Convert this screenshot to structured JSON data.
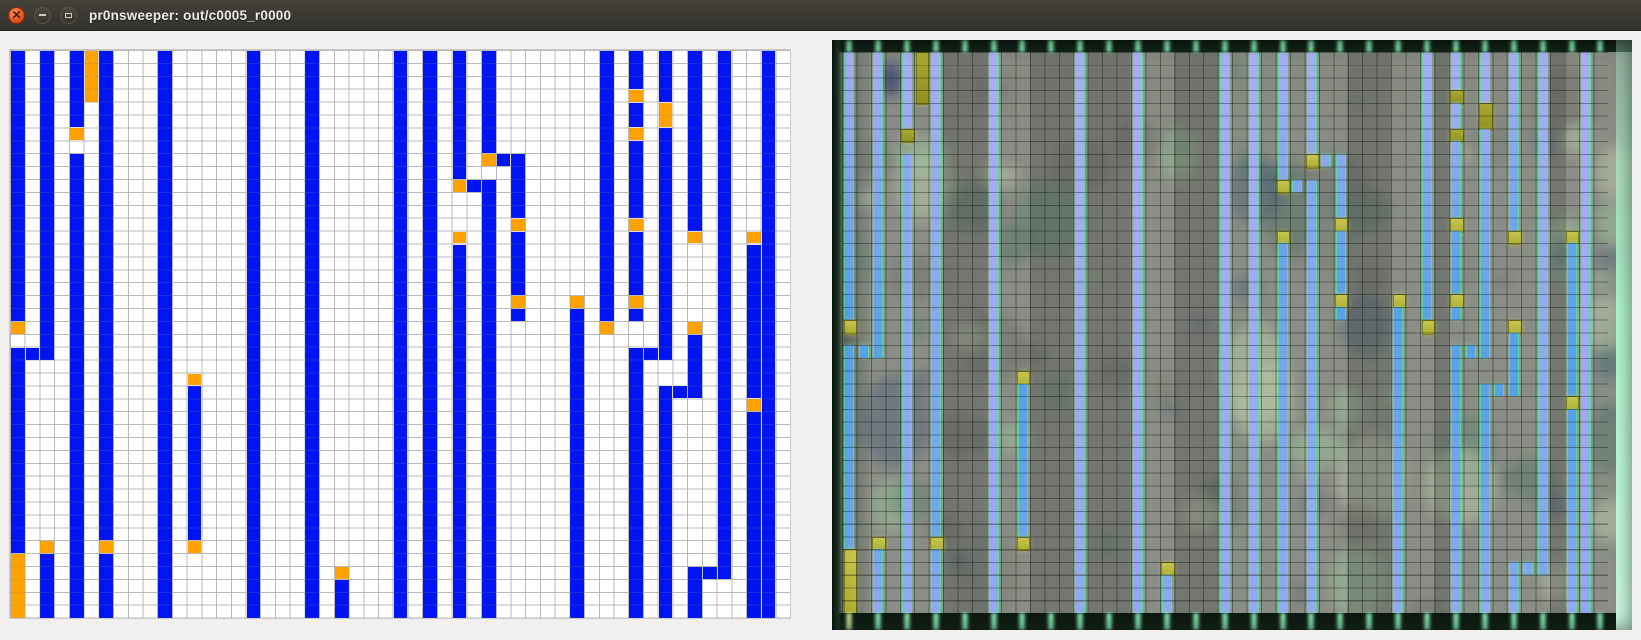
{
  "window": {
    "title": "pr0nsweeper: out/c0005_r0000",
    "controls": {
      "close": "close-icon",
      "minimize": "minimize-icon",
      "maximize": "maximize-icon"
    }
  },
  "colors": {
    "titlebar_bg": "#3a3833",
    "close_button": "#e2582a",
    "mark_blue": "#0014f2",
    "flag_orange": "#ffa200",
    "grid_line": "#c9c9c9",
    "photo_bg": "#8b8e86",
    "trace_top_lavender": "#a9aef2",
    "trace_mid_blue": "#58a2e6",
    "flag_yellow": "#b9ba3c",
    "flag_olive_dark": "#9b9b26",
    "band_dark_green": "#0c1710",
    "band_streak_mint": "#8af2bc",
    "photo_edge_mint": "#aef3cd"
  },
  "bit_grid": {
    "cols": 53,
    "rows": 44,
    "legend": {
      "B": "blue-trace-mark",
      "O": "orange-flag-mark"
    },
    "columns": [
      {
        "col": 0,
        "runs": [
          [
            0,
            20,
            "B"
          ],
          [
            21,
            21,
            "O"
          ],
          [
            23,
            38,
            "B"
          ],
          [
            39,
            43,
            "O"
          ]
        ]
      },
      {
        "col": 1,
        "runs": [
          [
            23,
            23,
            "B"
          ]
        ]
      },
      {
        "col": 2,
        "runs": [
          [
            0,
            23,
            "B"
          ],
          [
            38,
            38,
            "O"
          ],
          [
            39,
            43,
            "B"
          ]
        ]
      },
      {
        "col": 4,
        "runs": [
          [
            0,
            5,
            "B"
          ],
          [
            6,
            6,
            "O"
          ],
          [
            8,
            43,
            "B"
          ]
        ]
      },
      {
        "col": 5,
        "runs": [
          [
            0,
            3,
            "O"
          ]
        ]
      },
      {
        "col": 6,
        "runs": [
          [
            0,
            37,
            "B"
          ],
          [
            38,
            38,
            "O"
          ],
          [
            39,
            43,
            "B"
          ]
        ]
      },
      {
        "col": 10,
        "runs": [
          [
            0,
            43,
            "B"
          ]
        ]
      },
      {
        "col": 12,
        "runs": [
          [
            25,
            25,
            "O"
          ],
          [
            26,
            37,
            "B"
          ],
          [
            38,
            38,
            "O"
          ]
        ]
      },
      {
        "col": 16,
        "runs": [
          [
            0,
            43,
            "B"
          ]
        ]
      },
      {
        "col": 20,
        "runs": [
          [
            0,
            43,
            "B"
          ]
        ]
      },
      {
        "col": 22,
        "runs": [
          [
            40,
            40,
            "O"
          ],
          [
            41,
            43,
            "B"
          ]
        ]
      },
      {
        "col": 26,
        "runs": [
          [
            0,
            43,
            "B"
          ]
        ]
      },
      {
        "col": 28,
        "runs": [
          [
            0,
            43,
            "B"
          ]
        ]
      },
      {
        "col": 30,
        "runs": [
          [
            0,
            9,
            "B"
          ],
          [
            10,
            10,
            "O"
          ],
          [
            14,
            14,
            "O"
          ],
          [
            15,
            43,
            "B"
          ]
        ]
      },
      {
        "col": 31,
        "runs": [
          [
            10,
            10,
            "B"
          ]
        ]
      },
      {
        "col": 32,
        "runs": [
          [
            0,
            7,
            "B"
          ],
          [
            8,
            8,
            "O"
          ],
          [
            10,
            43,
            "B"
          ]
        ]
      },
      {
        "col": 33,
        "runs": [
          [
            8,
            8,
            "B"
          ]
        ]
      },
      {
        "col": 34,
        "runs": [
          [
            8,
            12,
            "B"
          ],
          [
            13,
            13,
            "O"
          ],
          [
            14,
            18,
            "B"
          ],
          [
            19,
            19,
            "O"
          ],
          [
            20,
            20,
            "B"
          ]
        ]
      },
      {
        "col": 38,
        "runs": [
          [
            19,
            19,
            "O"
          ],
          [
            20,
            43,
            "B"
          ]
        ]
      },
      {
        "col": 40,
        "runs": [
          [
            0,
            20,
            "B"
          ],
          [
            21,
            21,
            "O"
          ]
        ]
      },
      {
        "col": 42,
        "runs": [
          [
            0,
            2,
            "B"
          ],
          [
            3,
            3,
            "O"
          ],
          [
            4,
            5,
            "B"
          ],
          [
            6,
            6,
            "O"
          ],
          [
            7,
            12,
            "B"
          ],
          [
            13,
            13,
            "O"
          ],
          [
            14,
            18,
            "B"
          ],
          [
            19,
            19,
            "O"
          ],
          [
            20,
            20,
            "B"
          ],
          [
            23,
            43,
            "B"
          ]
        ]
      },
      {
        "col": 43,
        "runs": [
          [
            23,
            23,
            "B"
          ]
        ]
      },
      {
        "col": 44,
        "runs": [
          [
            0,
            3,
            "B"
          ],
          [
            4,
            5,
            "O"
          ],
          [
            6,
            23,
            "B"
          ],
          [
            26,
            43,
            "B"
          ]
        ]
      },
      {
        "col": 45,
        "runs": [
          [
            26,
            26,
            "B"
          ]
        ]
      },
      {
        "col": 46,
        "runs": [
          [
            0,
            13,
            "B"
          ],
          [
            14,
            14,
            "O"
          ],
          [
            21,
            21,
            "O"
          ],
          [
            22,
            26,
            "B"
          ],
          [
            40,
            43,
            "B"
          ]
        ]
      },
      {
        "col": 47,
        "runs": [
          [
            40,
            40,
            "B"
          ]
        ]
      },
      {
        "col": 48,
        "runs": [
          [
            0,
            40,
            "B"
          ]
        ]
      },
      {
        "col": 50,
        "runs": [
          [
            14,
            14,
            "O"
          ],
          [
            15,
            26,
            "B"
          ],
          [
            27,
            27,
            "O"
          ],
          [
            28,
            43,
            "B"
          ]
        ]
      },
      {
        "col": 51,
        "runs": [
          [
            0,
            43,
            "B"
          ]
        ]
      }
    ]
  },
  "die_photo": {
    "has_top_metal_band": true,
    "has_bottom_metal_band": true,
    "streaks_on_even_columns": true,
    "traces_follow_bit_grid": true
  }
}
